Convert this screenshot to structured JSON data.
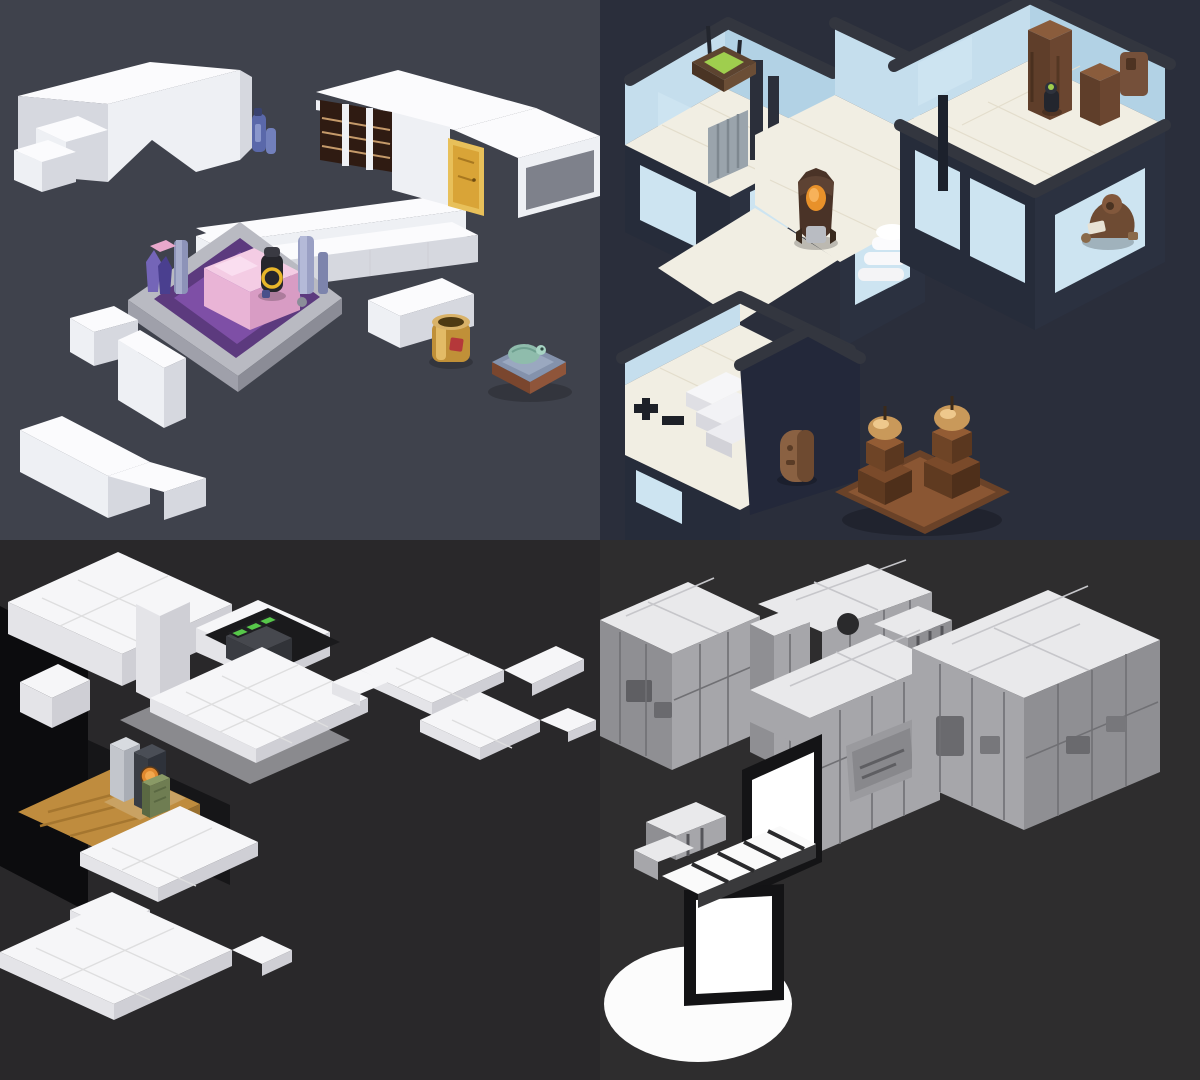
{
  "image": {
    "kind": "four-up grid of isometric low-poly game level concept renders",
    "grid": {
      "rows": 2,
      "cols": 2,
      "cell_width": 600,
      "cell_height": 540
    }
  },
  "panels": [
    {
      "id": "top-left",
      "title": "White low-poly room fragments with sunken purple bed platform",
      "background": "#3f424c",
      "palette": {
        "wall_top": "#fbfbfd",
        "wall_face": "#eef0f4",
        "wall_shade": "#d6d8df",
        "platform_concrete": "#b9bac2",
        "carpet_outer": "#5c3a7e",
        "carpet_inner": "#7e4fa6",
        "bed_top": "#f4cce4",
        "bed_side": "#d89cc4",
        "bookshelf": "#2f1b12",
        "shelf_line": "#c59a6a",
        "door_gold": "#d9a437",
        "flask_blue": "#5a68aa",
        "barrel_gold": "#c09038",
        "barrel_label": "#b5383a",
        "mattress_blue": "#8492ac",
        "mattress_trim": "#8a5138",
        "robot_teal": "#8fbcac"
      },
      "objects": [
        "angled white wall cluster",
        "blue flask on ledge",
        "white sofa wall",
        "bookshelf wall",
        "gold door",
        "right wing wall with dark glass",
        "concrete platform",
        "purple carpet",
        "pink bed",
        "crystal props",
        "pillar props",
        "black and yellow bot",
        "white zigzag corridor walls",
        "gold barrel",
        "blue mattress with teal robot"
      ]
    },
    {
      "id": "top-right",
      "title": "Cut-away sci-fi rooms: blue walls, cream tile, robot and bronze generators",
      "background": "#2a2e3b",
      "palette": {
        "parapet": "#33363f",
        "wall_blue": "#c5deed",
        "wall_blue_dark": "#b2d2e5",
        "glass": "#cde4f1",
        "floor_cream": "#f1eee3",
        "outer_wall": "#262c3a",
        "lantern_glow": "#9fce4e",
        "robot_cloak": "#4a3327",
        "robot_light": "#e8912a",
        "bronze": "#8a5c3c",
        "bronze_glow": "#eec88c",
        "capsule": "#8a6142"
      },
      "objects": [
        "top-left room",
        "hanging green lantern",
        "gray locker slats",
        "wall door panels",
        "center corridor",
        "cloaked robot with orange light",
        "white spiral stairs",
        "right room",
        "brown server towers",
        "small green-visor figure",
        "robed figure reading outside wall",
        "bottom room with low walls",
        "white steps",
        "black wall brackets",
        "leaning brown capsule",
        "two bronze generator towers on brown base"
      ]
    },
    {
      "id": "bottom-left",
      "title": "Floating white tile platforms over a dark void with sunken machine room",
      "background": "#29282a",
      "palette": {
        "tile_top": "#f6f6f8",
        "tile_side_light": "#e4e4e8",
        "tile_side_dark": "#cfcfd5",
        "void_wall": "#0c0c0e",
        "ramp_gray": "#8a8a8e",
        "wood_floor": "#bf8c3e",
        "console_screen": "#57c74a",
        "figure_head_gold": "#d9b260",
        "machine_orange": "#f2a84e",
        "cabinet_green": "#6f7d52"
      },
      "objects": [
        "upper-left tiled platform",
        "white pillar",
        "side block",
        "gray ramp",
        "dark void wall",
        "central tiled platform",
        "sunken console with three green screens",
        "gold-helmet figure",
        "cross-shaped tiled platforms",
        "sunken machine room with wood plank floor",
        "silver pillar machine",
        "dark pillar with orange emblem",
        "green cabinet",
        "lower L platform",
        "thin tile bar",
        "bottom stepped platform"
      ]
    },
    {
      "id": "bottom-right",
      "title": "Gray stone bunker with glowing white doorway, striped walkway and light pool",
      "background": "#2e2d2e",
      "palette": {
        "stone_top": "#e9e9eb",
        "stone_face": "#a6a6aa",
        "stone_face_dark": "#8f8f93",
        "stone_seam": "#707074",
        "hatch_gray": "#88888c",
        "doorway_white": "#ffffff",
        "frame_black": "#131315",
        "light_pool": "#fcfcfc"
      },
      "objects": [
        "upper stone wall bar with porthole",
        "striped stone block",
        "left stone platform with panels",
        "stone pillar",
        "center stone platform",
        "metal hatch",
        "glowing white doorway",
        "right stone platform with panel details",
        "small stone blocks",
        "white striped walkway",
        "black-framed white door pillar",
        "white light pool ellipse"
      ]
    }
  ]
}
